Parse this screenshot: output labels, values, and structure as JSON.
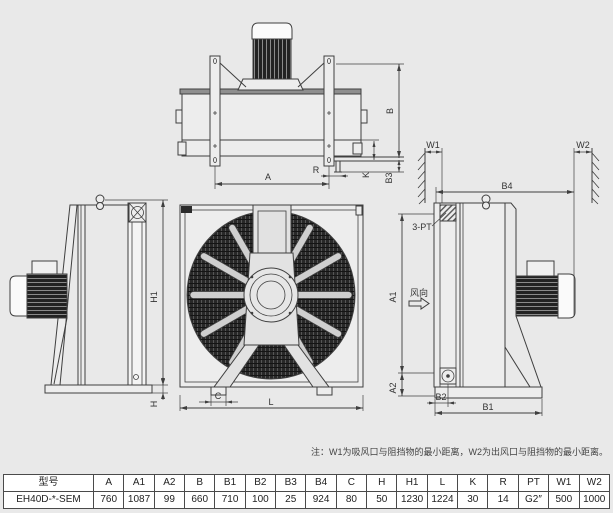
{
  "colors": {
    "bg": "#e9e9e9",
    "line": "#3f3f3f",
    "dark_fill": "#2b2b2b",
    "cell_bg": "#ffffff"
  },
  "labels": {
    "A": "A",
    "A1": "A1",
    "A2": "A2",
    "B": "B",
    "B1": "B1",
    "B2": "B2",
    "B3": "B3",
    "B4": "B4",
    "C": "C",
    "H": "H",
    "H1": "H1",
    "K": "K",
    "L": "L",
    "R": "R",
    "W1": "W1",
    "W2": "W2",
    "port": "3-PT",
    "wind": "风向"
  },
  "note": "注：W1为吸风口与阻挡物的最小距离，W2为出风口与阻挡物的最小距离。",
  "table": {
    "headers": [
      "型号",
      "A",
      "A1",
      "A2",
      "B",
      "B1",
      "B2",
      "B3",
      "B4",
      "C",
      "H",
      "H1",
      "L",
      "K",
      "R",
      "PT",
      "W1",
      "W2"
    ],
    "rows": [
      [
        "EH40D-*-SEM",
        "760",
        "1087",
        "99",
        "660",
        "710",
        "100",
        "25",
        "924",
        "80",
        "50",
        "1230",
        "1224",
        "30",
        "14",
        "G2″",
        "500",
        "1000"
      ]
    ]
  }
}
